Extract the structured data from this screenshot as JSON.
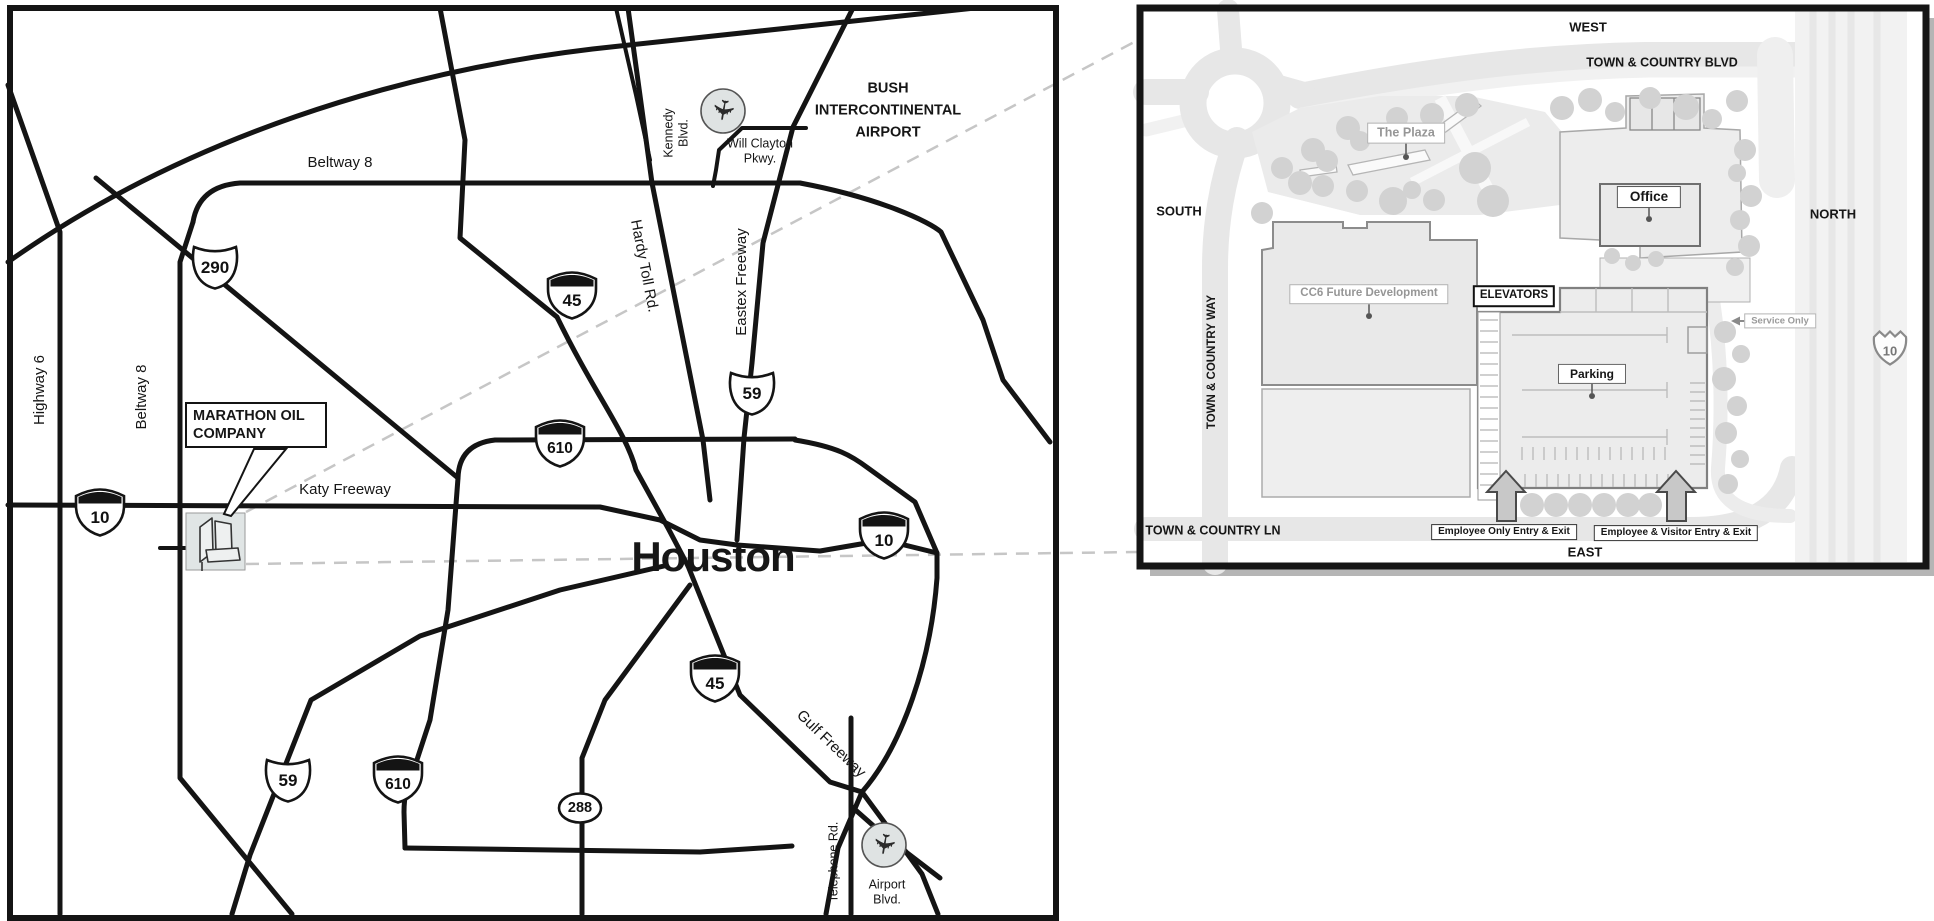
{
  "main_map": {
    "city": "Houston",
    "labels": {
      "beltway8_top": "Beltway 8",
      "beltway8_left": "Beltway 8",
      "highway6": "Highway 6",
      "kennedy_1": "Kennedy",
      "kennedy_2": "Blvd.",
      "will_clayton_1": "Will Clayton",
      "will_clayton_2": "Pkwy.",
      "bush_1": "BUSH",
      "bush_2": "INTERCONTINENTAL",
      "bush_3": "AIRPORT",
      "hardy": "Hardy Toll Rd.",
      "eastex": "Eastex Freeway",
      "katy": "Katy Freeway",
      "gulf": "Gulf Freeway",
      "telephone": "Telephone Rd.",
      "airport_blvd_1": "Airport",
      "airport_blvd_2": "Blvd."
    },
    "marathon": {
      "line1": "MARATHON OIL",
      "line2": "COMPANY"
    },
    "shields": {
      "us290": "290",
      "i45_north": "45",
      "us59_north": "59",
      "i610_north": "610",
      "i10_west": "10",
      "i10_east": "10",
      "i45_south": "45",
      "us59_south": "59",
      "i610_south": "610",
      "sh288": "288"
    },
    "icons": {
      "airplane": "✈"
    }
  },
  "inset": {
    "directions": {
      "west": "WEST",
      "north": "NORTH",
      "south": "SOUTH",
      "east": "EAST"
    },
    "streets": {
      "blvd": "TOWN & COUNTRY BLVD",
      "way": "TOWN & COUNTRY WAY",
      "ln": "TOWN & COUNTRY LN"
    },
    "places": {
      "plaza": "The Plaza",
      "office": "Office",
      "cc6": "CC6 Future Development",
      "elevators": "ELEVATORS",
      "parking": "Parking",
      "service": "Service Only"
    },
    "shield10": "10",
    "entries": {
      "employee_only": "Employee Only Entry & Exit",
      "employee_visitor": "Employee & Visitor Entry & Exit"
    }
  },
  "colors": {
    "road": "#141414",
    "inset_road": "#e7e7e7",
    "tree": "#d2d2d2",
    "dashed_leader": "#c6c6c6"
  }
}
